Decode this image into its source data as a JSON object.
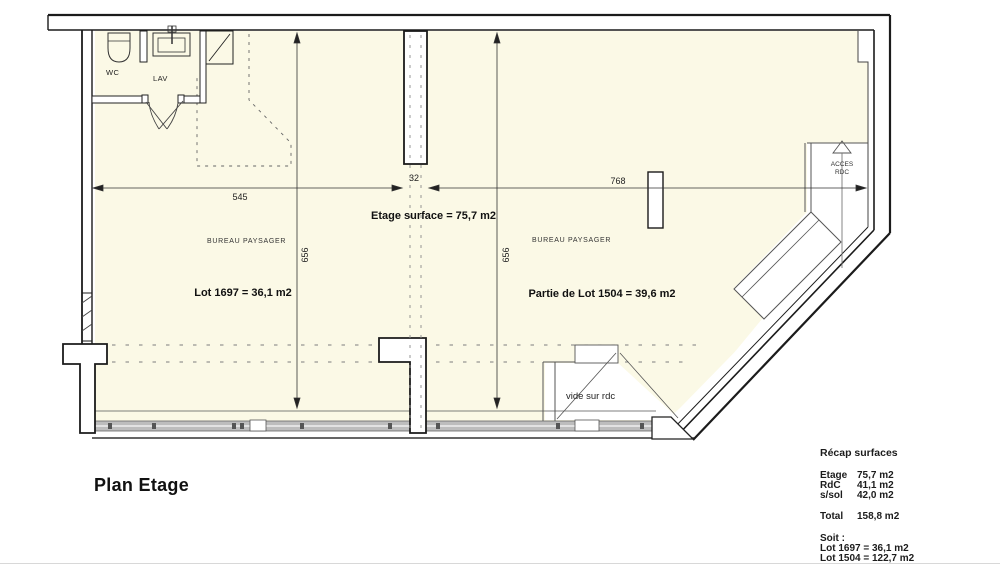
{
  "title": "Plan Etage",
  "plan": {
    "rooms": {
      "wc": "WC",
      "lav": "LAV",
      "bureau_left": "BUREAU PAYSAGER",
      "bureau_right": "BUREAU PAYSAGER"
    },
    "labels": {
      "etage_surface": "Etage surface = 75,7 m2",
      "lot_left": "Lot 1697 = 36,1 m2",
      "lot_right": "Partie de Lot 1504 = 39,6 m2",
      "vide": "vide sur rdc",
      "acces_line1": "ACCES",
      "acces_line2": "RDC"
    },
    "dimensions": {
      "width_left": "545",
      "wall_thickness": "32",
      "width_right": "768",
      "height_left": "656",
      "height_right": "656"
    }
  },
  "recap": {
    "title": "Récap surfaces",
    "rows": [
      {
        "label": "Etage",
        "value": "75,7 m2"
      },
      {
        "label": "RdC",
        "value": "41,1 m2"
      },
      {
        "label": "s/sol",
        "value": "42,0 m2"
      }
    ],
    "total_label": "Total",
    "total_value": "158,8 m2",
    "soit_title": "Soit :",
    "soit_lines": [
      "Lot 1697 = 36,1 m2",
      "Lot 1504 = 122,7 m2"
    ]
  },
  "colors": {
    "floor": "#FBF9E6",
    "window_band": "#bdbdbd",
    "wall": "#1b1b1b"
  }
}
